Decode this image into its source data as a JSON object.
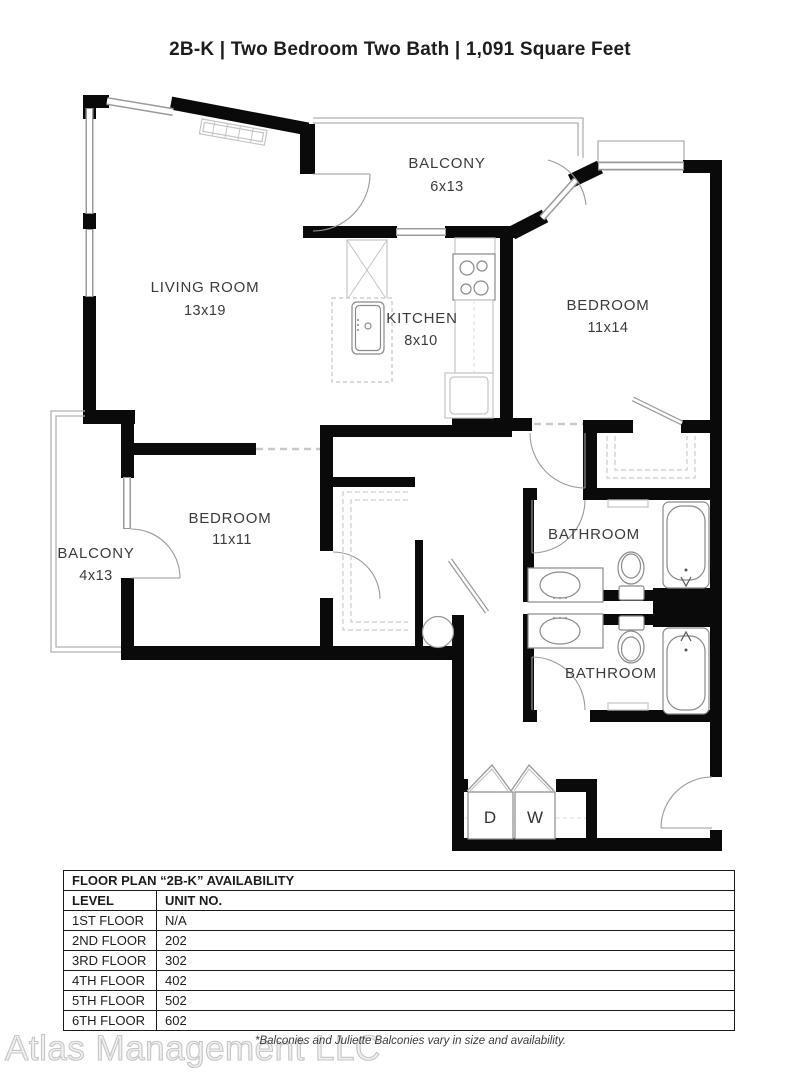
{
  "header": {
    "title": "2B-K | Two Bedroom Two Bath | 1,091 Square Feet"
  },
  "floor_plan": {
    "rooms": {
      "balcony_top": {
        "name": "BALCONY",
        "dims": "6x13"
      },
      "living_room": {
        "name": "LIVING ROOM",
        "dims": "13x19"
      },
      "kitchen": {
        "name": "KITCHEN",
        "dims": "8x10"
      },
      "bedroom_1": {
        "name": "BEDROOM",
        "dims": "11x14"
      },
      "bedroom_2": {
        "name": "BEDROOM",
        "dims": "11x11"
      },
      "balcony_left": {
        "name": "BALCONY",
        "dims": "4x13"
      },
      "bathroom_1": {
        "name": "BATHROOM"
      },
      "bathroom_2": {
        "name": "BATHROOM"
      }
    },
    "appliances": {
      "dryer": "D",
      "washer": "W"
    }
  },
  "availability": {
    "title": "FLOOR PLAN “2B-K” AVAILABILITY",
    "columns": [
      "LEVEL",
      "UNIT NO."
    ],
    "rows": [
      [
        "1ST FLOOR",
        "N/A"
      ],
      [
        "2ND FLOOR",
        "202"
      ],
      [
        "3RD FLOOR",
        "302"
      ],
      [
        "4TH FLOOR",
        "402"
      ],
      [
        "5TH FLOOR",
        "502"
      ],
      [
        "6TH FLOOR",
        "602"
      ]
    ]
  },
  "footer": {
    "watermark": "Atlas Management LLC",
    "note": "*Balconies and Juliette Balconies vary in size and availability."
  }
}
